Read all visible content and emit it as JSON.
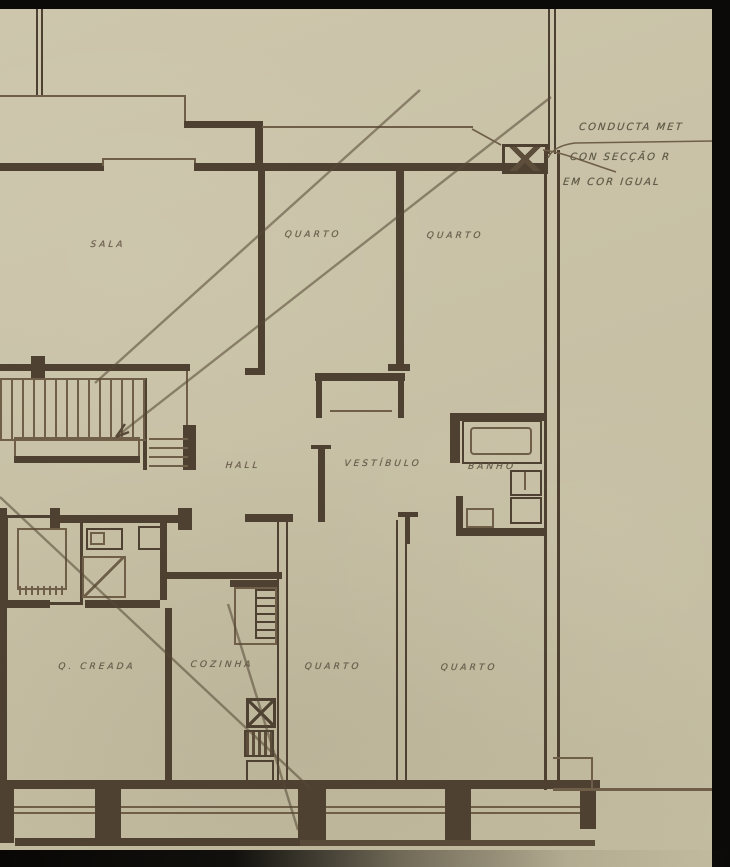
{
  "drawing_title": "apartment floor plan (scanned hand-drawn blueprint)",
  "colors": {
    "paper": "#c8c1a6",
    "ink_wall": "#4e4132",
    "pencil_line": "#6f5f48",
    "lettering": "#5f5343",
    "scan_bar": "#0b0a08"
  },
  "rooms": [
    {
      "id": "sala",
      "label": "SALA"
    },
    {
      "id": "quarto-upper-left",
      "label": "QUARTO"
    },
    {
      "id": "quarto-upper-right",
      "label": "QUARTO"
    },
    {
      "id": "hall",
      "label": "HALL"
    },
    {
      "id": "vestibulo",
      "label": "VESTÍBULO"
    },
    {
      "id": "banho",
      "label": "BANHO"
    },
    {
      "id": "quarto-creada",
      "label": "Q. CREADA"
    },
    {
      "id": "cozinha",
      "label": "COZINHA"
    },
    {
      "id": "quarto-lower-left",
      "label": "QUARTO"
    },
    {
      "id": "quarto-lower-right",
      "label": "QUARTO"
    },
    {
      "id": "edge-fragment",
      "label": "A"
    }
  ],
  "annotations": {
    "line1": "CONDUCTA MET",
    "line2": "CON SECÇÃO R",
    "line3": "EM COR IGUAL"
  }
}
